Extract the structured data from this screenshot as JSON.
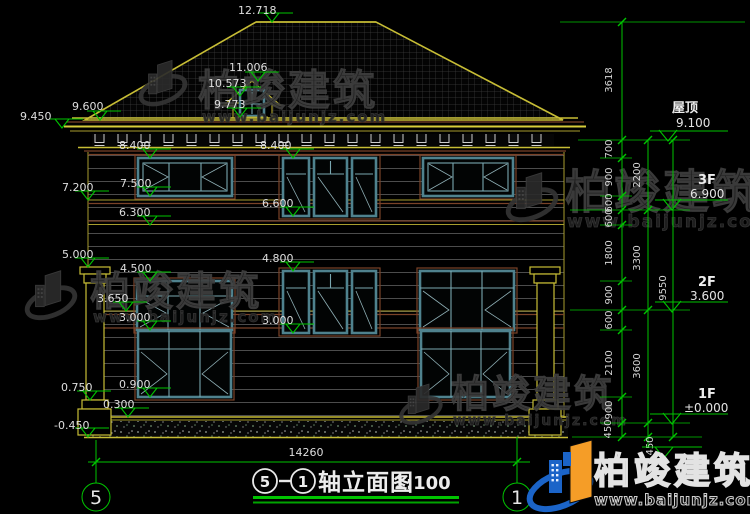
{
  "drawing": {
    "title_axis_start": "5",
    "title_axis_end": "1",
    "title_text": "轴立面图",
    "title_scale": "1:100",
    "axis_bubble_left": "5",
    "axis_bubble_right": "1"
  },
  "levels_left": {
    "peak": "12.718",
    "dormer_ridge": "11.006",
    "dormer_eave": "10.573",
    "dormer_sill": "9.773",
    "eave_top": "9.600",
    "eave_low": "9.450",
    "f3_win_top_l": "8.400",
    "f3_win_top_c": "8.400",
    "f3_sill_l": "7.500",
    "band1_top": "7.200",
    "f3_sill_c": "6.600",
    "band1_bot": "6.300",
    "pilaster_cap": "5.000",
    "f2_win_top_c": "4.800",
    "f2_win_top_l": "4.500",
    "band2_top": "3.650",
    "f2_sill_l": "3.000",
    "f2_sill_c": "3.000",
    "f1_sill": "0.900",
    "pilaster_base": "0.750",
    "plinth": "0.300",
    "ground": "-0.450"
  },
  "dims_right": {
    "roof_height": "3618",
    "chain_inner": [
      "700",
      "900",
      "600",
      "600",
      "1800",
      "900",
      "600",
      "2100",
      "900",
      "450"
    ],
    "chain_mid": [
      "2200",
      "3300",
      "3600",
      "450"
    ],
    "total": "9550"
  },
  "levels_right": [
    {
      "label": "屋顶",
      "value": "9.100"
    },
    {
      "label": "3F",
      "value": "6.900"
    },
    {
      "label": "2F",
      "value": "3.600"
    },
    {
      "label": "1F",
      "value": "±0.000"
    }
  ],
  "dims_bottom": {
    "overall_width": "14260"
  },
  "watermark": {
    "brand": "柏竣建筑",
    "url": "www.baijunjz.com"
  },
  "logo": {
    "brand": "柏竣建筑",
    "url": "www.baijunjz.com"
  },
  "colors": {
    "background": "#000000",
    "dimension_green": "#00c400",
    "outline_yellow": "#c7bd35",
    "trim_brown": "#7a4228",
    "window_teal": "#4f828e",
    "logo_blue": "#1b64c8",
    "logo_orange": "#f59d27"
  }
}
